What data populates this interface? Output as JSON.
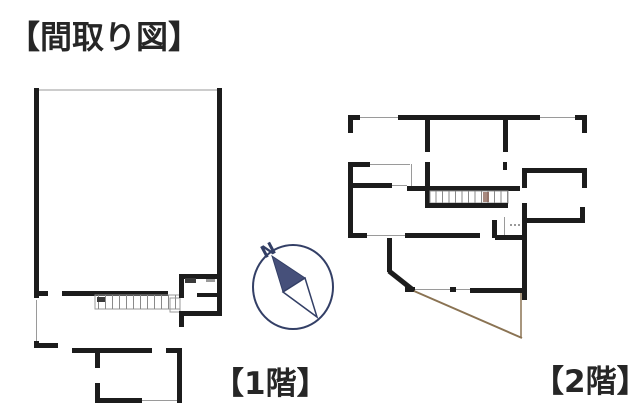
{
  "page": {
    "title": "【間取り図】"
  },
  "floors": {
    "floor1": {
      "label": "【1階】"
    },
    "floor2": {
      "label": "【2階】"
    }
  },
  "compass": {
    "north_label": "N"
  },
  "theme": {
    "wall_color": "#1c1c1c",
    "thin_line_color": "#9a9a9a",
    "compass_color": "#333f66",
    "needle_fill": "#46507a",
    "roof_line_color": "#8a7353",
    "background": "#ffffff",
    "text_color": "#262626"
  }
}
